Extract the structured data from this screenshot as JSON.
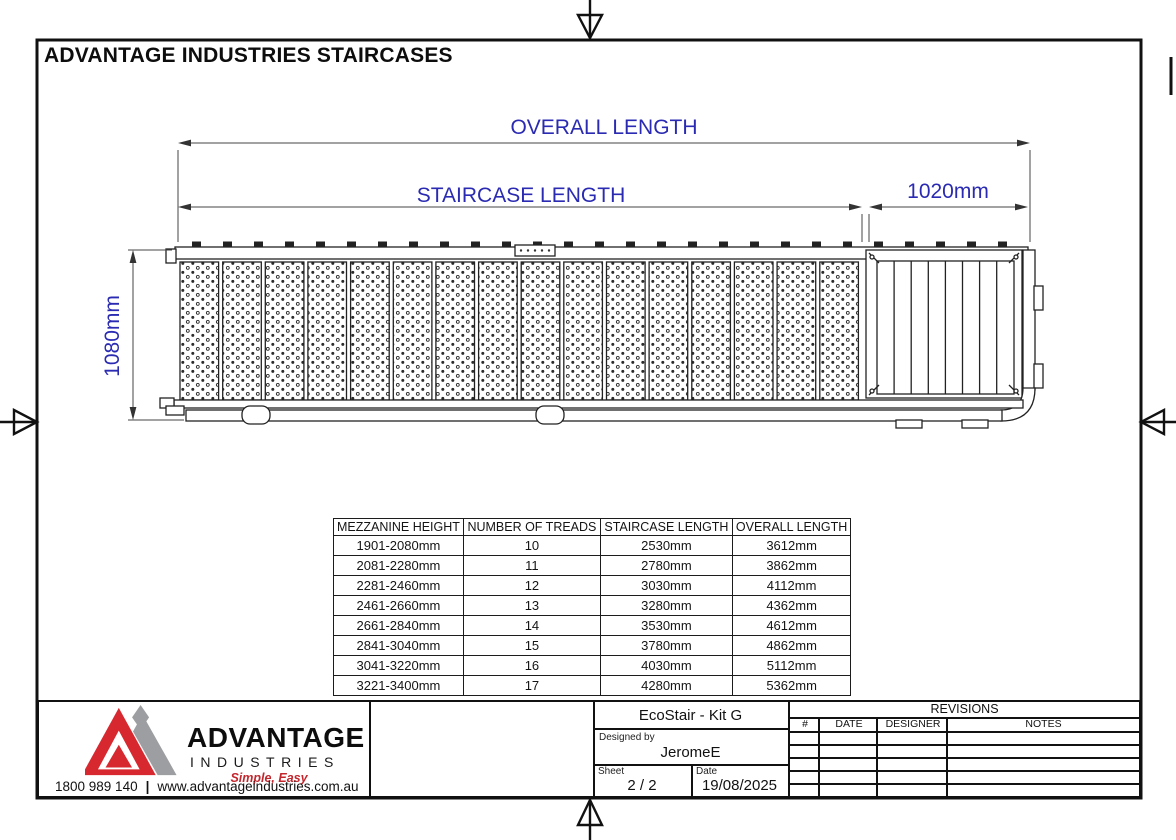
{
  "sheet": {
    "title": "ADVANTAGE INDUSTRIES STAIRCASES",
    "accent_color": "#2a2ab2",
    "line_color": "#111111"
  },
  "dimensions": {
    "overall_length_label": "OVERALL LENGTH",
    "staircase_length_label": "STAIRCASE LENGTH",
    "landing_length": "1020mm",
    "staircase_width": "1080mm"
  },
  "spec_table": {
    "headers": [
      "MEZZANINE HEIGHT",
      "NUMBER OF TREADS",
      "STAIRCASE LENGTH",
      "OVERALL LENGTH"
    ],
    "rows": [
      [
        "1901-2080mm",
        "10",
        "2530mm",
        "3612mm"
      ],
      [
        "2081-2280mm",
        "11",
        "2780mm",
        "3862mm"
      ],
      [
        "2281-2460mm",
        "12",
        "3030mm",
        "4112mm"
      ],
      [
        "2461-2660mm",
        "13",
        "3280mm",
        "4362mm"
      ],
      [
        "2661-2840mm",
        "14",
        "3530mm",
        "4612mm"
      ],
      [
        "2841-3040mm",
        "15",
        "3780mm",
        "4862mm"
      ],
      [
        "3041-3220mm",
        "16",
        "4030mm",
        "5112mm"
      ],
      [
        "3221-3400mm",
        "17",
        "4280mm",
        "5362mm"
      ]
    ]
  },
  "title_block": {
    "product": "EcoStair - Kit G",
    "designed_by_label": "Designed by",
    "designed_by": "JeromeE",
    "sheet_label": "Sheet",
    "sheet_value": "2 / 2",
    "date_label": "Date",
    "date_value": "19/08/2025",
    "revisions": {
      "title": "REVISIONS",
      "columns": [
        "#",
        "DATE",
        "DESIGNER",
        "NOTES"
      ],
      "empty_row_count": 5
    }
  },
  "brand": {
    "name": "ADVANTAGE",
    "division": "INDUSTRIES",
    "tagline": "Simple, Easy",
    "phone": "1800 989 140",
    "separator": "|",
    "website": "www.advantageindustries.com.au",
    "logo_red": "#d7282f",
    "logo_gray": "#9c9ea1"
  }
}
